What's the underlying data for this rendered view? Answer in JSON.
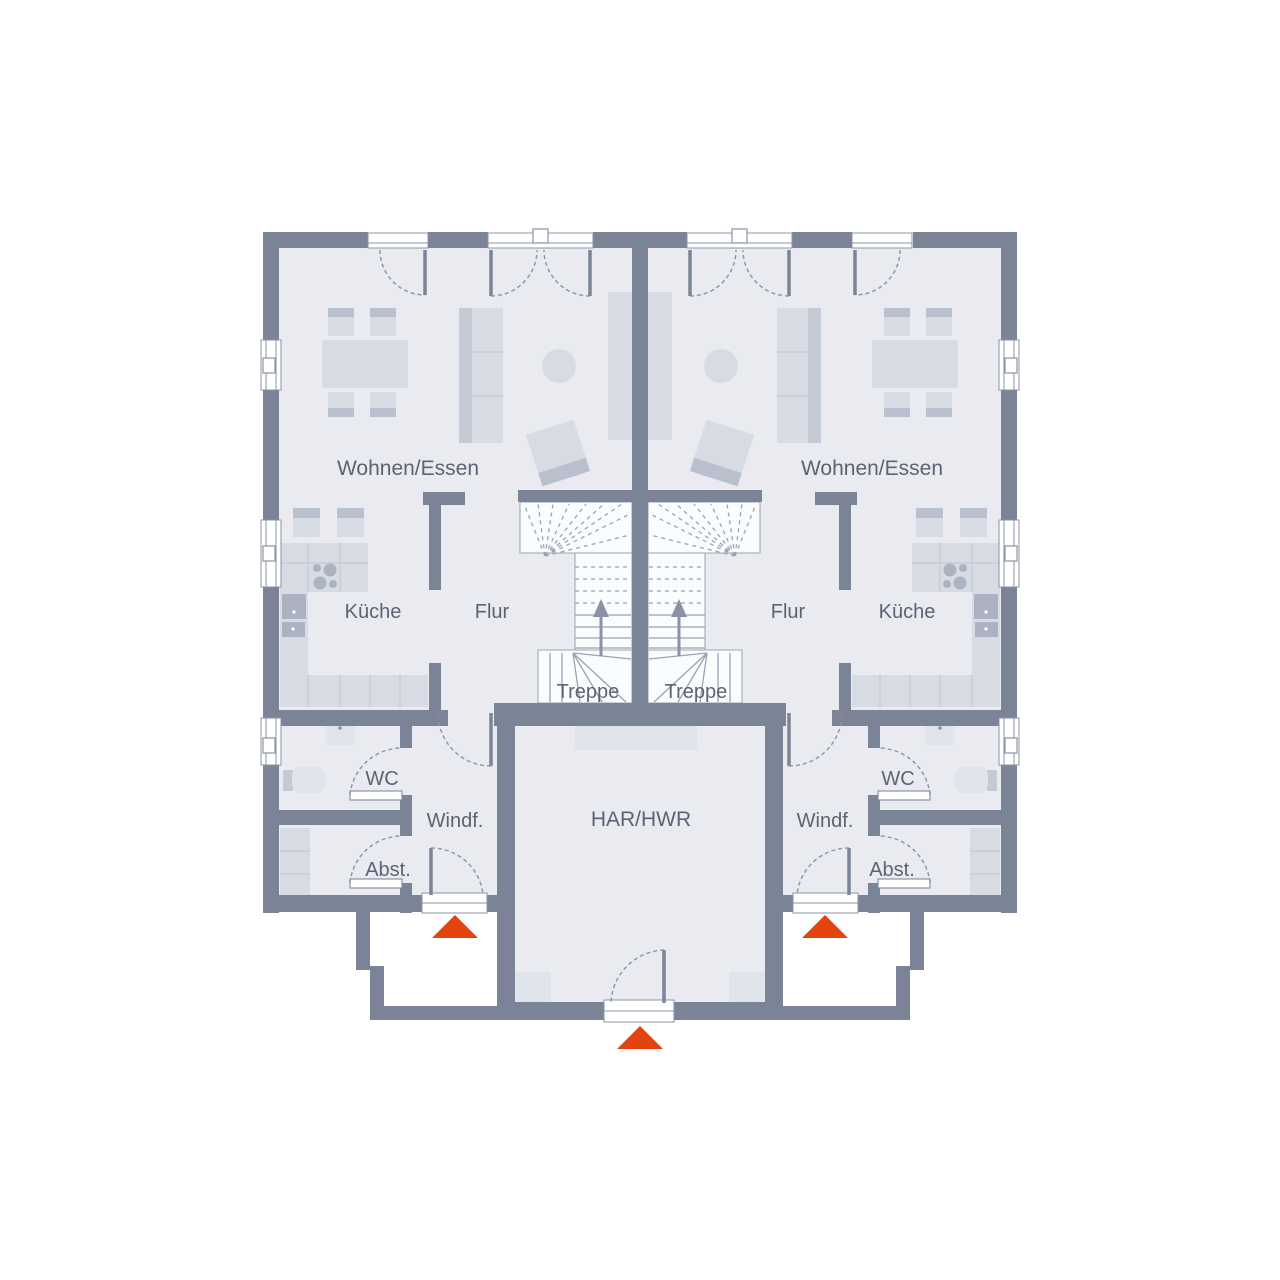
{
  "rooms": {
    "living": "Wohnen/Essen",
    "kitchen": "Küche",
    "hall": "Flur",
    "stairs": "Treppe",
    "wc": "WC",
    "vestibule": "Windf.",
    "storage": "Abst.",
    "utility": "HAR/HWR"
  },
  "colors": {
    "wall": "#7B8496",
    "floor": "#E9EBF1",
    "furniture": "#D7DBE4",
    "furniture_dark": "#B9C0CE",
    "stair_background": "#FBFCFE",
    "line": "#8A93A5",
    "label": "#5B6474",
    "entrance_arrow": "#E2430F",
    "exterior": "#FFFFFF"
  }
}
